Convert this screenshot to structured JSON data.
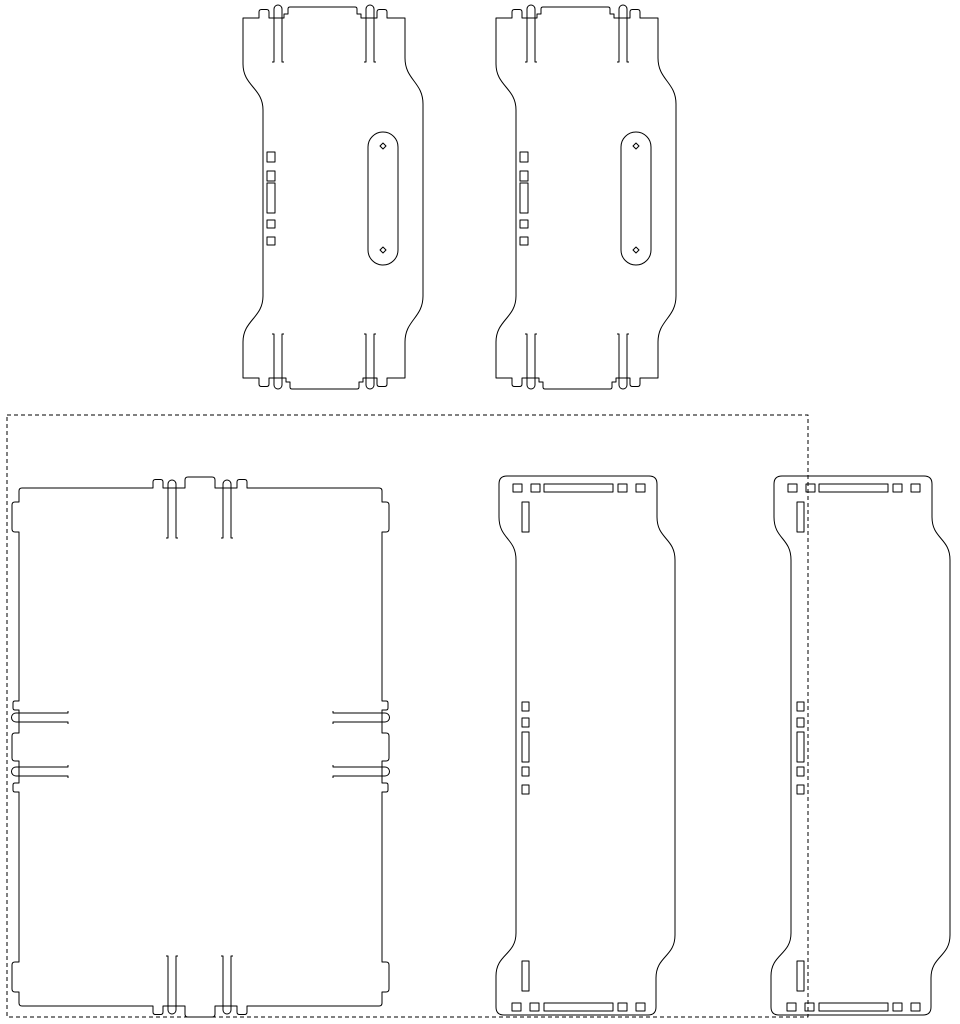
{
  "canvas": {
    "width": 960,
    "height": 1024,
    "background_color": "#ffffff",
    "line_color": "#000000",
    "line_width": 1,
    "content": "2D CAD flat-pattern nesting layout, stroke-only line drawing, no text"
  },
  "boundary": {
    "kind": "dashed-sheet-outline",
    "d": "M 7,415 H 808 V 1017 H 7 Z",
    "dash_pattern": "4 3"
  },
  "shapes": {
    "top_plate": {
      "paths": [
        "M 243,18 H 259 v -6 q 0,-2.5 2.5,-2.5 h 5 q 2.5,0 2.5,2.5 v 6 H 284 v -4 h 4 v -5 q 0,-2 2,-2 H 355 q 2,0 2,2 v 5 h 4 v 4 H 377 v -6 q 0,-2.5 2.5,-2.5 h 5 q 2.5,0 2.5,2.5 v 6 H 405 V 58 c 0,22 18,24 18,46 V 296 c 0,22 -18,24 -18,46 V 378 H 387 v 6 q 0,2.5 -2.5,2.5 h -5 q -2.5,0 -2.5,-2.5 v -6 H 363 v 4 h -4 v 5 q 0,2 -2,2 H 292 q -2,0 -2,-2 v -5 h -4 v -4 H 269 v 6 q 0,2.5 -2.5,2.5 h -5 q -2.5,0 -2.5,-2.5 v -6 H 243 V 342 c 0,-22 20,-24 20,-46 V 110 c 0,-22 -20,-24 -20,-46 Z",
        "M 272,62 h 2 v -53 a 4,4 0 0 1 8,0 v 53 h 2",
        "M 364,62 h 2 v -53 a 4,4 0 0 1 8,0 v 53 h 2",
        "M 272,334 h 2 v 51 a 4,4 0 0 0 8,0 v -51 h 2",
        "M 364,334 h 2 v 51 a 4,4 0 0 0 8,0 v -51 h 2",
        "M 267,152 h 8 v 10 h -8 Z",
        "M 267,171 h 8 v 10 h -8 Z",
        "M 267,183 h 8 v 30 h -8 Z",
        "M 267,220 h 8 v 8 h -8 Z",
        "M 267,237 h 8 v 8 h -8 Z",
        "M 368,147 a 15,15 0 0 1 30,0 V 250 a 15,15 0 0 1 -30,0 Z",
        "M 383,143 l 3,3 l -3,3 l -3,-3 Z",
        "M 383,247 l 3,3 l -3,3 l -3,-3 Z"
      ]
    },
    "base_panel": {
      "paths": [
        "M 22,488 H 153 v -6 q 0,-2.5 2.5,-2.5 h 5 q 2.5,0 2.5,2.5 v 6 H 185 v -8 q 0,-3 3,-3 H 212 q 3,0 3,3 v 8 H 237 v -6 q 0,-2.5 2.5,-2.5 h 5 q 2.5,0 2.5,2.5 v 6 H 379 q 3,0 3,3 V 502 h 4 q 3,0 3,3 v 24 q 0,3 -3,3 h -4 V 701 h 4 q 2,0 2,2 v 5 q 0,2 -2,2 h -4 V 733 h 4 q 3,0 3,3 v 22 q 0,3 -3,3 h -4 V 783 h 4 q 2,0 2,2 v 5 q 0,2 -2,2 h -4 V 962 h 4 q 3,0 3,3 v 24 q 0,3 -3,3 h -4 V 1003 q 0,3 -3,3 H 247 v 6 q 0,2.5 -2.5,2.5 h -5 q -2.5,0 -2.5,-2.5 v -6 H 215 v 8 q 0,3 -3,3 H 188 q -3,0 -3,-3 v -8 H 163 v 6 q 0,2.5 -2.5,2.5 h -5 q -2.5,0 -2.5,-2.5 v -6 H 22 q -3,0 -3,-3 V 992 h -4 q -3,0 -3,-3 v -24 q 0,-3 3,-3 h 4 V 792 h -4 q -2,0 -2,-2 v -5 q 0,-2 2,-2 h 4 V 761 h -4 q -3,0 -3,-3 v -22 q 0,-3 3,-3 h 4 V 710 h -4 q -2,0 -2,-2 v -5 q 0,-2 2,-2 h 4 V 532 h -4 q -3,0 -3,-3 v -24 q 0,-3 3,-3 h 4 V 491 q 0,-3 3,-3 Z",
        "M 166,538 h 2 v -54 a 4,4 0 0 1 8,0 v 54 h 2",
        "M 221,538 h 2 v -54 a 4,4 0 0 1 8,0 v 54 h 2",
        "M 166,956 h 2 v 54 a 4,4 0 0 0 8,0 v -54 h 2",
        "M 221,956 h 2 v 54 a 4,4 0 0 0 8,0 v -54 h 2",
        "M 68,711 v 2 H 16 a 4.5,4.5 0 0 0 0,9 H 68 v 2",
        "M 68,765 v 2 H 16 a 4.5,4.5 0 0 0 0,9 H 68 v 2",
        "M 333,711 v 2 H 385 a 4.5,4.5 0 0 1 0,9 H 333 v 2",
        "M 333,765 v 2 H 385 a 4.5,4.5 0 0 1 0,9 H 333 v 2"
      ]
    },
    "side_panel": {
      "paths": [
        "M 507,476 H 649 q 8,0 8,8 V 517 c 0,22 18,21 18,43 V 935 c 0,22 -19,21 -19,43 V 1007 q 0,8 -8,8 H 504 q -8,0 -8,-8 V 976 c 0,-22 20,-21 20,-43 V 560 c 0,-22 -17,-21 -17,-43 V 484 q 0,-8 8,-8 Z",
        "M 513,484 h 9 v 8 h -9 Z",
        "M 531,484 h 9 v 8 h -9 Z",
        "M 544,484 h 69 v 8 h -69 Z",
        "M 618,484 h 9 v 8 h -9 Z",
        "M 636,484 h 9 v 8 h -9 Z",
        "M 522,502 h 7 v 30 h -7 Z",
        "M 522,702 h 7 v 9 h -7 Z",
        "M 522,718 h 7 v 9 h -7 Z",
        "M 522,732 h 7 v 30 h -7 Z",
        "M 522,767 h 7 v 9 h -7 Z",
        "M 522,785 h 7 v 9 h -7 Z",
        "M 522,961 h 7 v 30 h -7 Z",
        "M 512,1003 h 9 v 8 h -9 Z",
        "M 530,1003 h 9 v 8 h -9 Z",
        "M 544,1003 h 69 v 8 h -69 Z",
        "M 618,1003 h 9 v 8 h -9 Z",
        "M 636,1003 h 9 v 8 h -9 Z"
      ]
    }
  },
  "instances": [
    {
      "shape": "top_plate",
      "transform": "translate(0,0)"
    },
    {
      "shape": "top_plate",
      "transform": "translate(253,0)"
    },
    {
      "shape": "base_panel",
      "transform": "translate(0,0)"
    },
    {
      "shape": "side_panel",
      "transform": "translate(0,0)"
    },
    {
      "shape": "side_panel",
      "transform": "translate(275,0)"
    }
  ]
}
